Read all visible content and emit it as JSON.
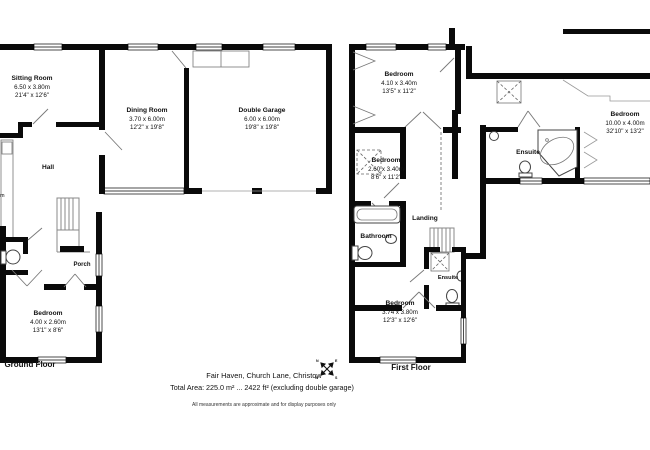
{
  "ground_floor": {
    "title": "Ground Floor",
    "sitting_room": {
      "name": "Sitting Room",
      "metric": "6.50 x 3.80m",
      "imperial": "21'4\" x 12'6\""
    },
    "dining_room": {
      "name": "Dining Room",
      "metric": "3.70 x 6.00m",
      "imperial": "12'2\" x 19'8\""
    },
    "double_garage": {
      "name": "Double Garage",
      "metric": "6.00 x 6.00m",
      "imperial": "19'8\" x 19'8\""
    },
    "hall": {
      "name": "Hall"
    },
    "porch": {
      "name": "Porch"
    },
    "bedroom": {
      "name": "Bedroom",
      "metric": "4.00 x 2.60m",
      "imperial": "13'1\" x 8'6\""
    },
    "edge_fragment": "m"
  },
  "first_floor": {
    "title": "First Floor",
    "bedroom_top": {
      "name": "Bedroom",
      "metric": "4.10 x 3.40m",
      "imperial": "13'5\" x 11'2\""
    },
    "bedroom_mid": {
      "name": "Bedroom",
      "metric": "2.60 x 3.40m",
      "imperial": "8'6\" x 11'2\""
    },
    "bathroom": {
      "name": "Bathroom"
    },
    "landing": {
      "name": "Landing"
    },
    "ensuite_inner": {
      "name": "Ensuite"
    },
    "ensuite_right": {
      "name": "Ensuite"
    },
    "bedroom_right": {
      "name": "Bedroom",
      "metric": "10.00 x 4.00m",
      "imperial": "32'10\" x 13'2\""
    },
    "bedroom_bottom": {
      "name": "Bedroom",
      "metric": "3.74 x 3.80m",
      "imperial": "12'3\" x 12'6\""
    }
  },
  "footer": {
    "address": "Fair Haven, Church Lane, Christow",
    "total_area": "Total Area: 225.0 m² ... 2422 ft² (excluding double garage)",
    "disclaimer": "All measurements are approximate and for display purposes only",
    "compass": {
      "n": "N",
      "e": "E",
      "s": "S",
      "w": "W"
    }
  }
}
